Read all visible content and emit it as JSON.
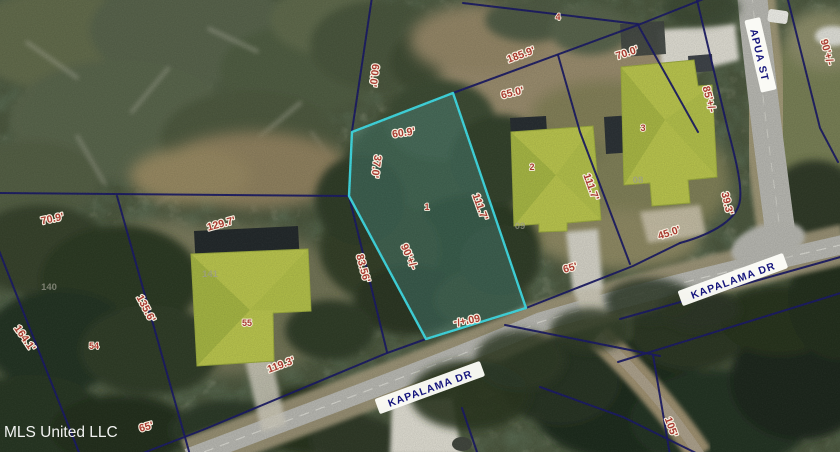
{
  "map": {
    "watermark": "MLS United LLC",
    "streets": [
      {
        "name": "KAPALAMA DR"
      },
      {
        "name": "KAPALAMA DR"
      },
      {
        "name": "APUA ST"
      }
    ],
    "dimension_labels": [
      "60.0'",
      "185.9'",
      "70.0'",
      "65.0'",
      "60.9'",
      "37.0'",
      "111.7'",
      "111.7'",
      "90'+/-",
      "60'+/-",
      "83.56'",
      "85'+/-",
      "90'+/-",
      "45.0'",
      "39.3'",
      "65'",
      "129.7'",
      "70.9'",
      "135.6'",
      "164.1'",
      "119.3'",
      "65'",
      "105'"
    ],
    "lot_numbers": [
      "1",
      "2",
      "3",
      "4",
      "55",
      "54"
    ],
    "faint_parcel_numbers": [
      "140",
      "141",
      "09",
      "08"
    ],
    "colors": {
      "highlight_parcel": "#3fd6de",
      "boundary_line": "#1a1a62",
      "dimension_text": "#a83b30",
      "street_text": "#15157d",
      "house_highlight": "#b5c04b"
    }
  }
}
